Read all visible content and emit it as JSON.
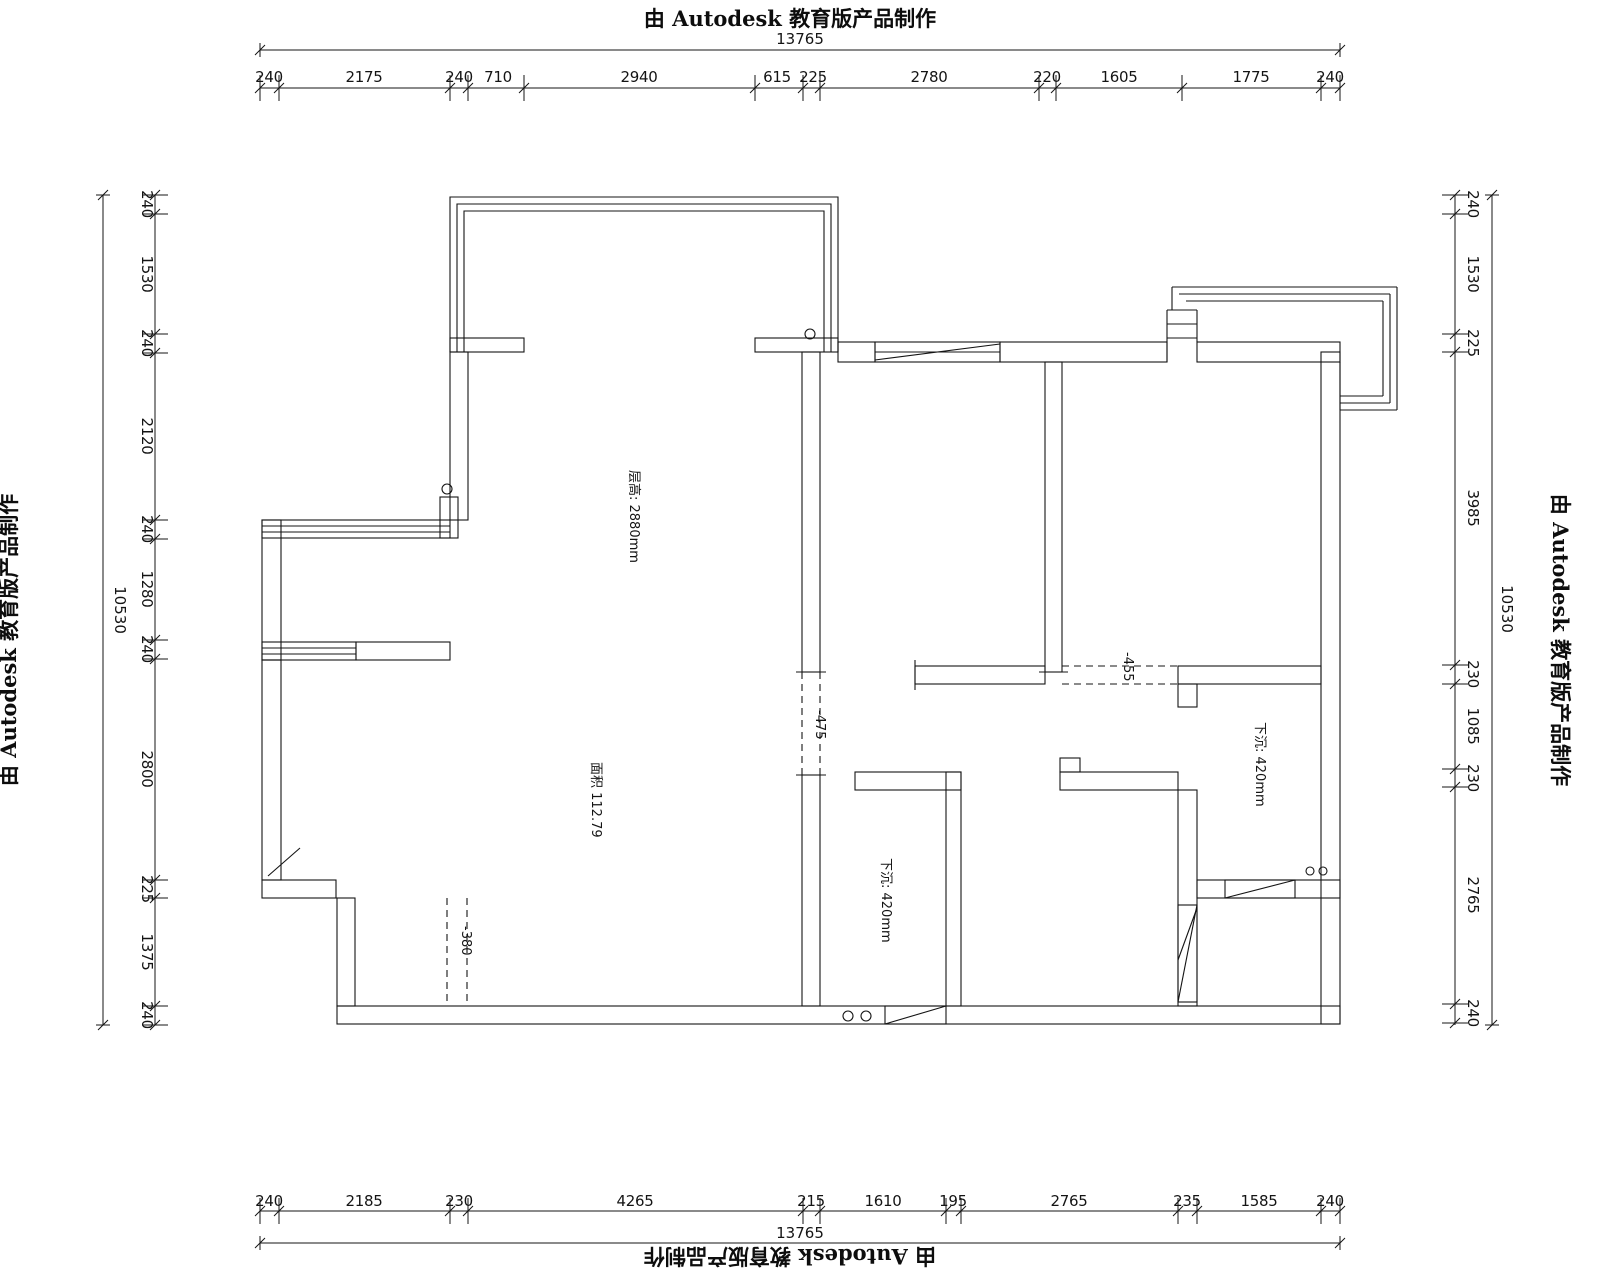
{
  "watermarks": {
    "top": "由 Autodesk 教育版产品制作",
    "bottom": "由 Autodesk 教育版产品制作",
    "left": "由 Autodesk 教育版产品制作",
    "right": "由 Autodesk 教育版产品制作"
  },
  "dims": {
    "top_total": "13765",
    "bottom_total": "13765",
    "left_total": "10530",
    "right_total": "10530",
    "top": [
      "240",
      "2175",
      "240",
      "710",
      "2940",
      "615",
      "225",
      "2780",
      "220",
      "1605",
      "1775",
      "240"
    ],
    "bottom": [
      "240",
      "2185",
      "230",
      "4265",
      "215",
      "1610",
      "195",
      "2765",
      "235",
      "1585",
      "240"
    ],
    "left": [
      "240",
      "1530",
      "240",
      "2120",
      "240",
      "1280",
      "240",
      "2800",
      "225",
      "1375",
      "240"
    ],
    "right": [
      "240",
      "1530",
      "225",
      "3985",
      "230",
      "1085",
      "230",
      "2765",
      "240"
    ]
  },
  "labels": {
    "ceiling": "层高: 2880mm",
    "area": "面积  112.79",
    "sunken_mid": "下沉: 420mm",
    "sunken_right": "下沉: 420mm",
    "drop475": "-475",
    "drop455": "-455",
    "drop380": "-380"
  }
}
